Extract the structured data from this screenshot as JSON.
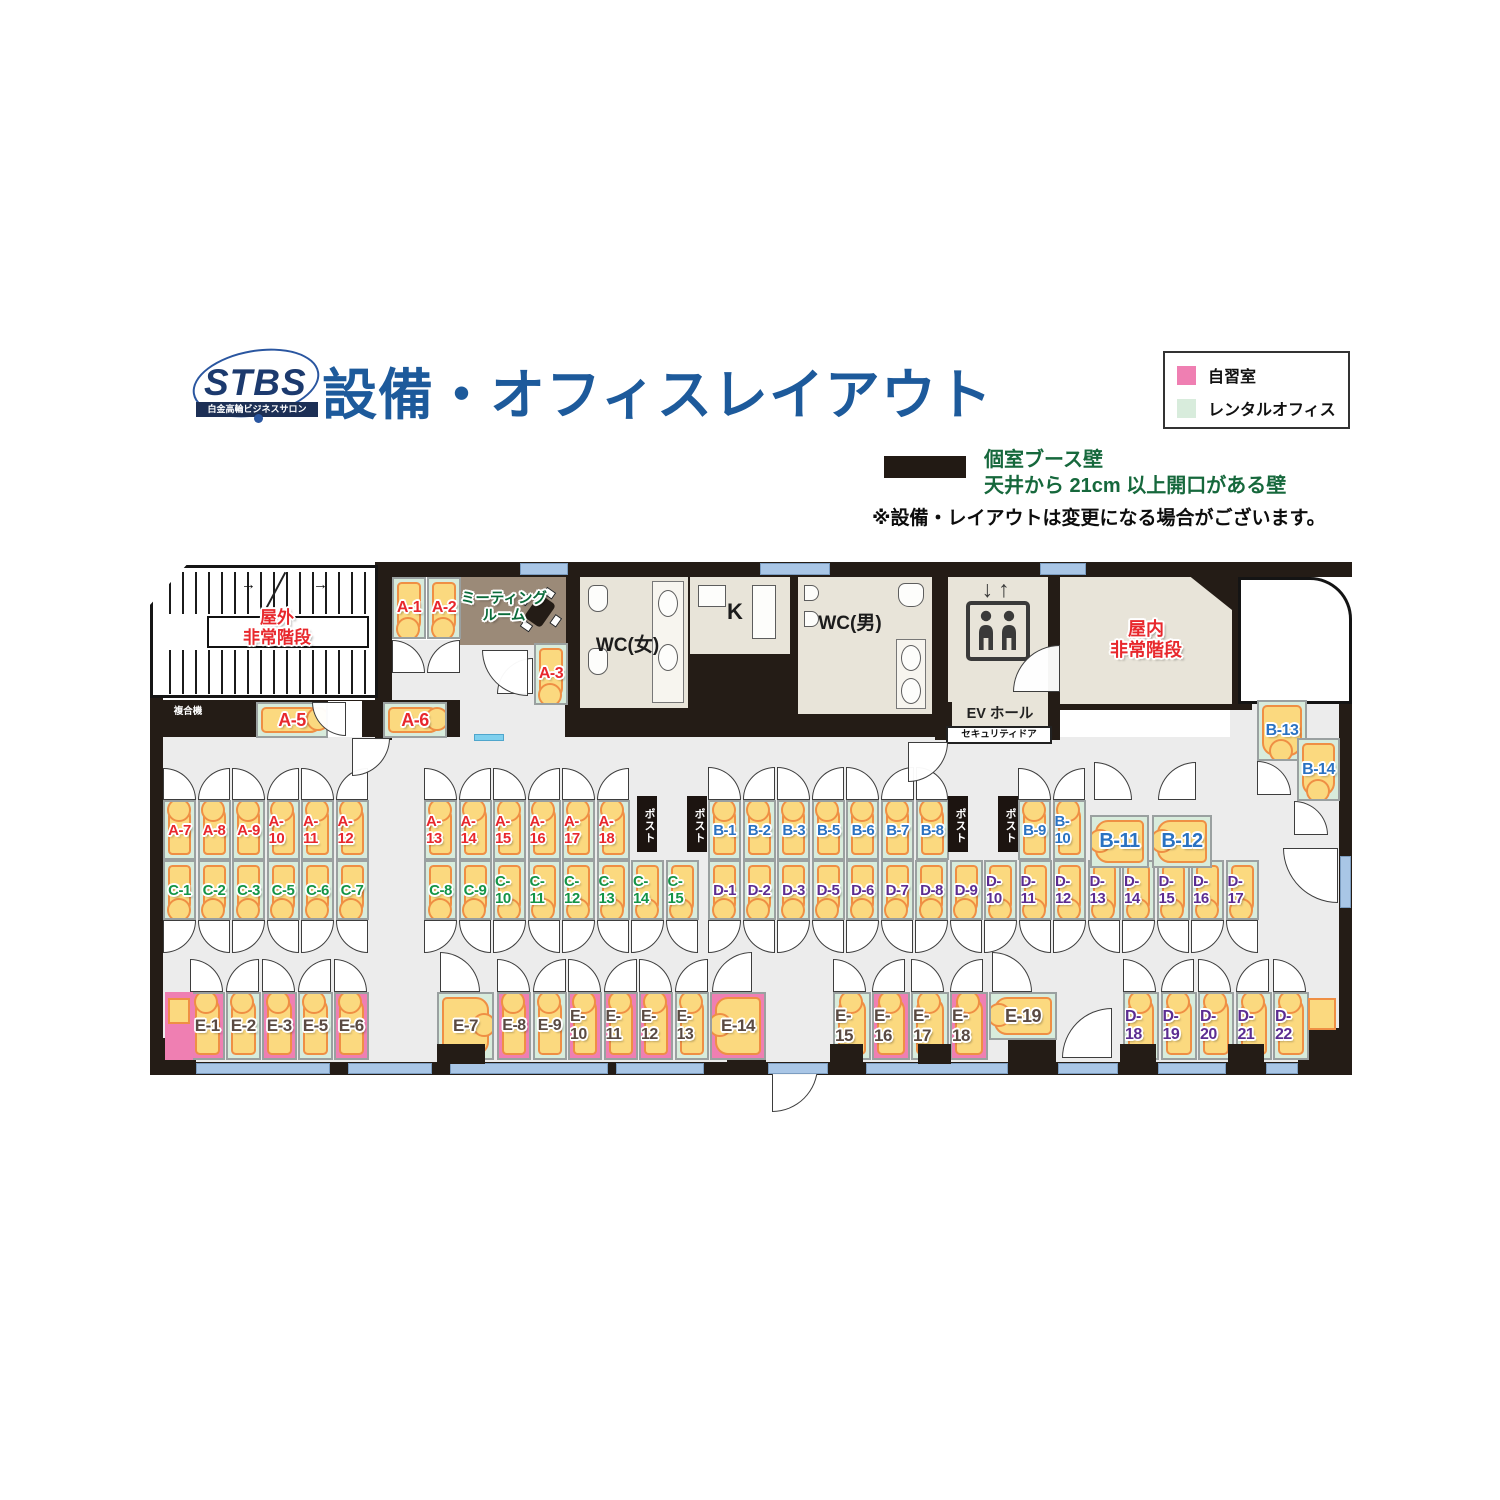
{
  "header": {
    "logo": "STBS",
    "logo_sub": "白金高輪ビジネスサロン",
    "title": "設備・オフィスレイアウト"
  },
  "legend": {
    "items": [
      {
        "label": "自習室",
        "color": "#ef7fb2"
      },
      {
        "label": "レンタルオフィス",
        "color": "#d8ecdc"
      }
    ],
    "wall_legend": {
      "line1": "個室ブース壁",
      "line2": "天井から 21cm 以上開口がある壁"
    },
    "note": "※設備・レイアウトは変更になる場合がございます。"
  },
  "series_colors": {
    "A": "#e8282d",
    "B": "#2a72c2",
    "C": "#149447",
    "D": "#5c2d91",
    "E": "#5a4a42"
  },
  "cell_colors": {
    "green": "#d8ecdc",
    "pink": "#ef7fb2"
  },
  "rooms": {
    "outdoor_stairs_1": "屋外",
    "outdoor_stairs_2": "非常階段",
    "meeting_1": "ミーティング",
    "meeting_2": "ルーム",
    "wc_f": "WC(女)",
    "kitchen": "K",
    "wc_m": "WC(男)",
    "ev_arrows": "↓↑",
    "ev_hall": "EV ホール",
    "security_door": "セキュリティドア",
    "indoor_stairs_1": "屋内",
    "indoor_stairs_2": "非常階段",
    "copier": "複合機",
    "post": "ポスト"
  },
  "booths": {
    "rowA1": [
      {
        "id": "A-7"
      },
      {
        "id": "A-8"
      },
      {
        "id": "A-9"
      },
      {
        "id": "A-10"
      },
      {
        "id": "A-11"
      },
      {
        "id": "A-12"
      }
    ],
    "rowA2": [
      {
        "id": "A-13"
      },
      {
        "id": "A-14"
      },
      {
        "id": "A-15"
      },
      {
        "id": "A-16"
      },
      {
        "id": "A-17"
      },
      {
        "id": "A-18"
      }
    ],
    "rowB1": [
      {
        "id": "B-1"
      },
      {
        "id": "B-2"
      },
      {
        "id": "B-3"
      },
      {
        "id": "B-5"
      },
      {
        "id": "B-6"
      },
      {
        "id": "B-7"
      },
      {
        "id": "B-8"
      }
    ],
    "rowB2": [
      {
        "id": "B-9"
      },
      {
        "id": "B-10"
      }
    ],
    "rowC1": [
      {
        "id": "C-1"
      },
      {
        "id": "C-2"
      },
      {
        "id": "C-3"
      },
      {
        "id": "C-5"
      },
      {
        "id": "C-6"
      },
      {
        "id": "C-7"
      }
    ],
    "rowC2": [
      {
        "id": "C-8"
      },
      {
        "id": "C-9"
      },
      {
        "id": "C-10"
      },
      {
        "id": "C-11"
      },
      {
        "id": "C-12"
      },
      {
        "id": "C-13"
      },
      {
        "id": "C-14"
      },
      {
        "id": "C-15"
      }
    ],
    "rowD": [
      {
        "id": "D-1"
      },
      {
        "id": "D-2"
      },
      {
        "id": "D-3"
      },
      {
        "id": "D-5"
      },
      {
        "id": "D-6"
      },
      {
        "id": "D-7"
      },
      {
        "id": "D-8"
      },
      {
        "id": "D-9"
      },
      {
        "id": "D-10"
      },
      {
        "id": "D-11"
      },
      {
        "id": "D-12"
      },
      {
        "id": "D-13"
      },
      {
        "id": "D-14"
      },
      {
        "id": "D-15"
      },
      {
        "id": "D-16"
      },
      {
        "id": "D-17"
      }
    ],
    "rowE1": [
      {
        "id": "E-1",
        "bg": "pink"
      },
      {
        "id": "E-2",
        "bg": "green"
      },
      {
        "id": "E-3",
        "bg": "pink"
      },
      {
        "id": "E-5",
        "bg": "green"
      },
      {
        "id": "E-6",
        "bg": "pink"
      }
    ],
    "rowE2": [
      {
        "id": "E-8",
        "bg": "pink"
      },
      {
        "id": "E-9",
        "bg": "green"
      },
      {
        "id": "E-10",
        "bg": "pink"
      },
      {
        "id": "E-11",
        "bg": "pink"
      },
      {
        "id": "E-12",
        "bg": "pink"
      },
      {
        "id": "E-13",
        "bg": "green"
      }
    ],
    "rowE3": [
      {
        "id": "E-15",
        "bg": "green"
      },
      {
        "id": "E-16",
        "bg": "pink"
      },
      {
        "id": "E-17",
        "bg": "green"
      },
      {
        "id": "E-18",
        "bg": "pink"
      }
    ],
    "rowD2": [
      {
        "id": "D-18",
        "bg": "green"
      },
      {
        "id": "D-19",
        "bg": "green"
      },
      {
        "id": "D-20",
        "bg": "green"
      },
      {
        "id": "D-21",
        "bg": "green"
      },
      {
        "id": "D-22",
        "bg": "green"
      }
    ]
  },
  "singles": [
    {
      "id": "A-1",
      "bg": "green"
    },
    {
      "id": "A-2",
      "bg": "green"
    },
    {
      "id": "A-3",
      "bg": "green"
    },
    {
      "id": "A-5",
      "bg": "green"
    },
    {
      "id": "A-6",
      "bg": "green"
    },
    {
      "id": "B-11",
      "bg": "green"
    },
    {
      "id": "B-12",
      "bg": "green"
    },
    {
      "id": "B-13",
      "bg": "green"
    },
    {
      "id": "B-14",
      "bg": "green"
    },
    {
      "id": "E-7",
      "bg": "green"
    },
    {
      "id": "E-14",
      "bg": "pink"
    },
    {
      "id": "E-19",
      "bg": "green"
    }
  ]
}
